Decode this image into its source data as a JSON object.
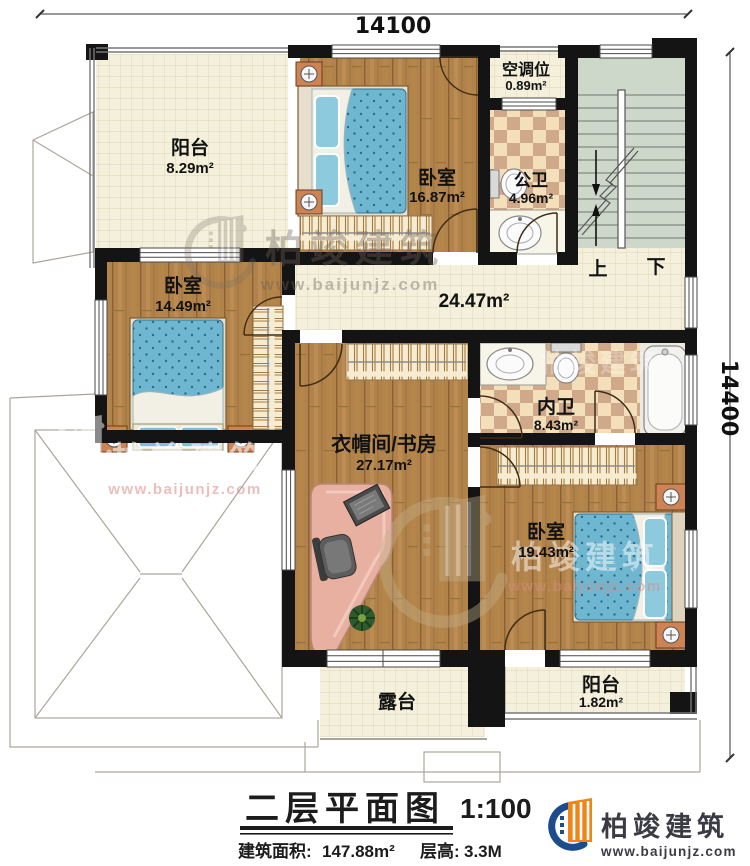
{
  "dimensions": {
    "width_top": "14100",
    "height_right": "14400"
  },
  "rooms": {
    "balcony_tl": {
      "name": "阳台",
      "area": "8.29m²"
    },
    "bedroom_top": {
      "name": "卧室",
      "area": "16.87m²"
    },
    "ac_bay": {
      "name": "空调位",
      "area": "0.89m²"
    },
    "public_bath": {
      "name": "公卫",
      "area": "4.96m²"
    },
    "corridor": {
      "area": "24.47m²"
    },
    "bedroom_left": {
      "name": "卧室",
      "area": "14.49m²"
    },
    "private_bath": {
      "name": "内卫",
      "area": "8.43m²"
    },
    "cloakroom_study": {
      "name": "衣帽间/书房",
      "area": "27.17m²"
    },
    "bedroom_br": {
      "name": "卧室",
      "area": "19.43m²"
    },
    "terrace": {
      "name": "露台"
    },
    "balcony_bottom": {
      "name": "阳台",
      "area": "1.82m²"
    }
  },
  "stairs": {
    "up": "上",
    "down": "下"
  },
  "title_block": {
    "title": "二层平面图",
    "scale": "1:100",
    "area_label": "建筑面积:",
    "area_value": "147.88m²",
    "floor_height_label": "层高:",
    "floor_height_value": "3.3M"
  },
  "logo": {
    "brand": "柏竣建筑",
    "url": "www.baijunjz.com"
  },
  "watermark": {
    "brand": "柏竣建筑",
    "url": "www.baijunjz.com"
  },
  "colors": {
    "wood": "#b1824a",
    "tile": "#f4f0dc",
    "checker": "#cfa98a",
    "stairs": "#cdd7ca",
    "bed": "#6fb7d0",
    "wall": "#141414",
    "logo_orange": "#ef8519",
    "logo_blue": "#1c4c8e"
  }
}
